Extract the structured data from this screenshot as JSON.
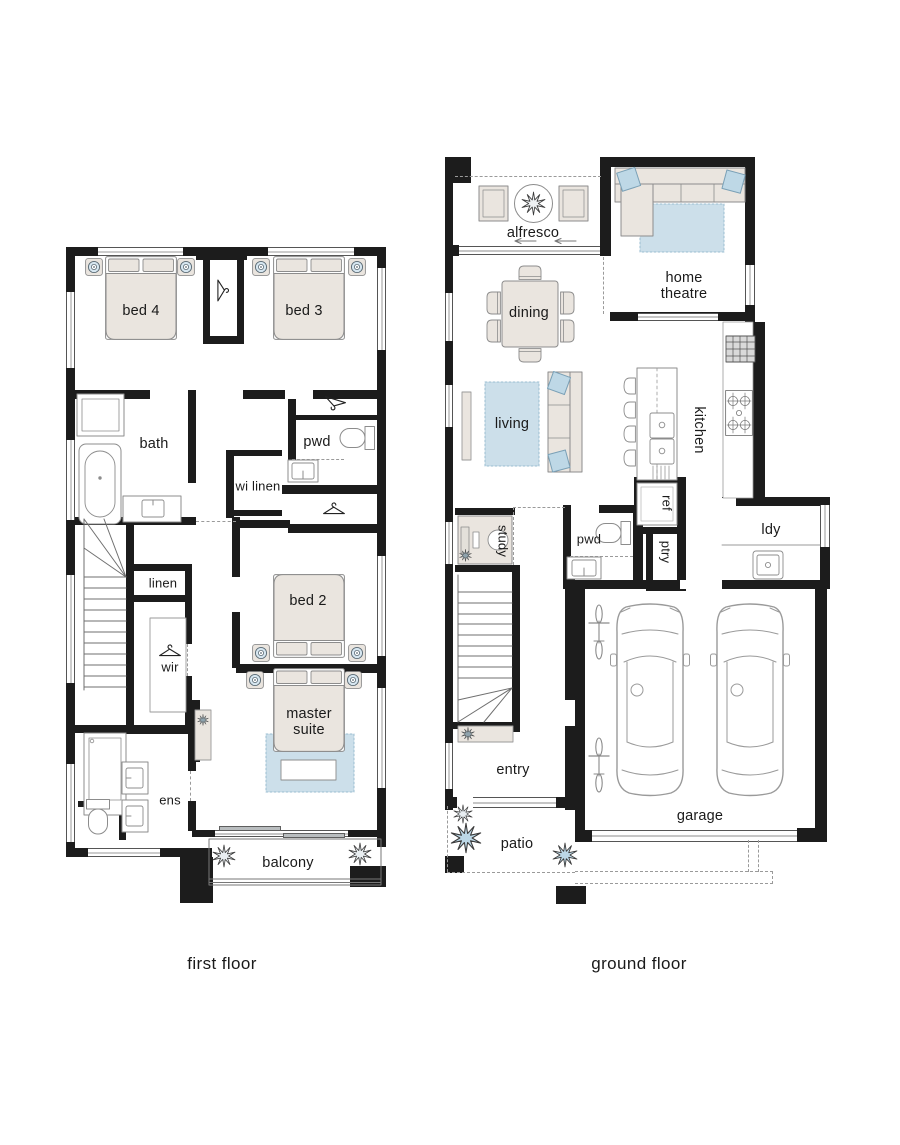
{
  "colors": {
    "wall": "#1c1c1c",
    "furniture_fill": "#eae5df",
    "accent_blue": "#ccdfea",
    "cushion_blue": "#bed8e6",
    "outline_gray": "#8c8c8c",
    "text": "#1a1a1a"
  },
  "captions": {
    "first_floor": "first floor",
    "ground_floor": "ground floor"
  },
  "first_floor": {
    "rooms": {
      "bed4": "bed 4",
      "bed3": "bed 3",
      "bath": "bath",
      "pwd": "pwd",
      "wi_linen": "wi linen",
      "linen": "linen",
      "wir": "wir",
      "bed2": "bed 2",
      "master_suite": "master suite",
      "ens": "ens",
      "balcony": "balcony"
    }
  },
  "ground_floor": {
    "rooms": {
      "alfresco": "alfresco",
      "home_theatre": "home theatre",
      "dining": "dining",
      "living": "living",
      "kitchen": "kitchen",
      "ref": "ref",
      "pwd": "pwd",
      "ptry": "ptry",
      "ldy": "ldy",
      "study": "study",
      "entry": "entry",
      "patio": "patio",
      "garage": "garage"
    }
  },
  "icons": [
    "bed-icon",
    "downlight-icon",
    "hanger-icon",
    "bathtub-icon",
    "shower-icon",
    "vanity-icon",
    "toilet-icon",
    "stairs-icon",
    "sofa-icon",
    "rug",
    "dining-table-icon",
    "chair-icon",
    "round-table-icon",
    "plant-icon",
    "car-icon",
    "bicycle-icon",
    "cooktop-icon",
    "oven-icon",
    "sink-icon",
    "fridge-icon",
    "desk-icon",
    "sliding-door",
    "window",
    "wall"
  ]
}
